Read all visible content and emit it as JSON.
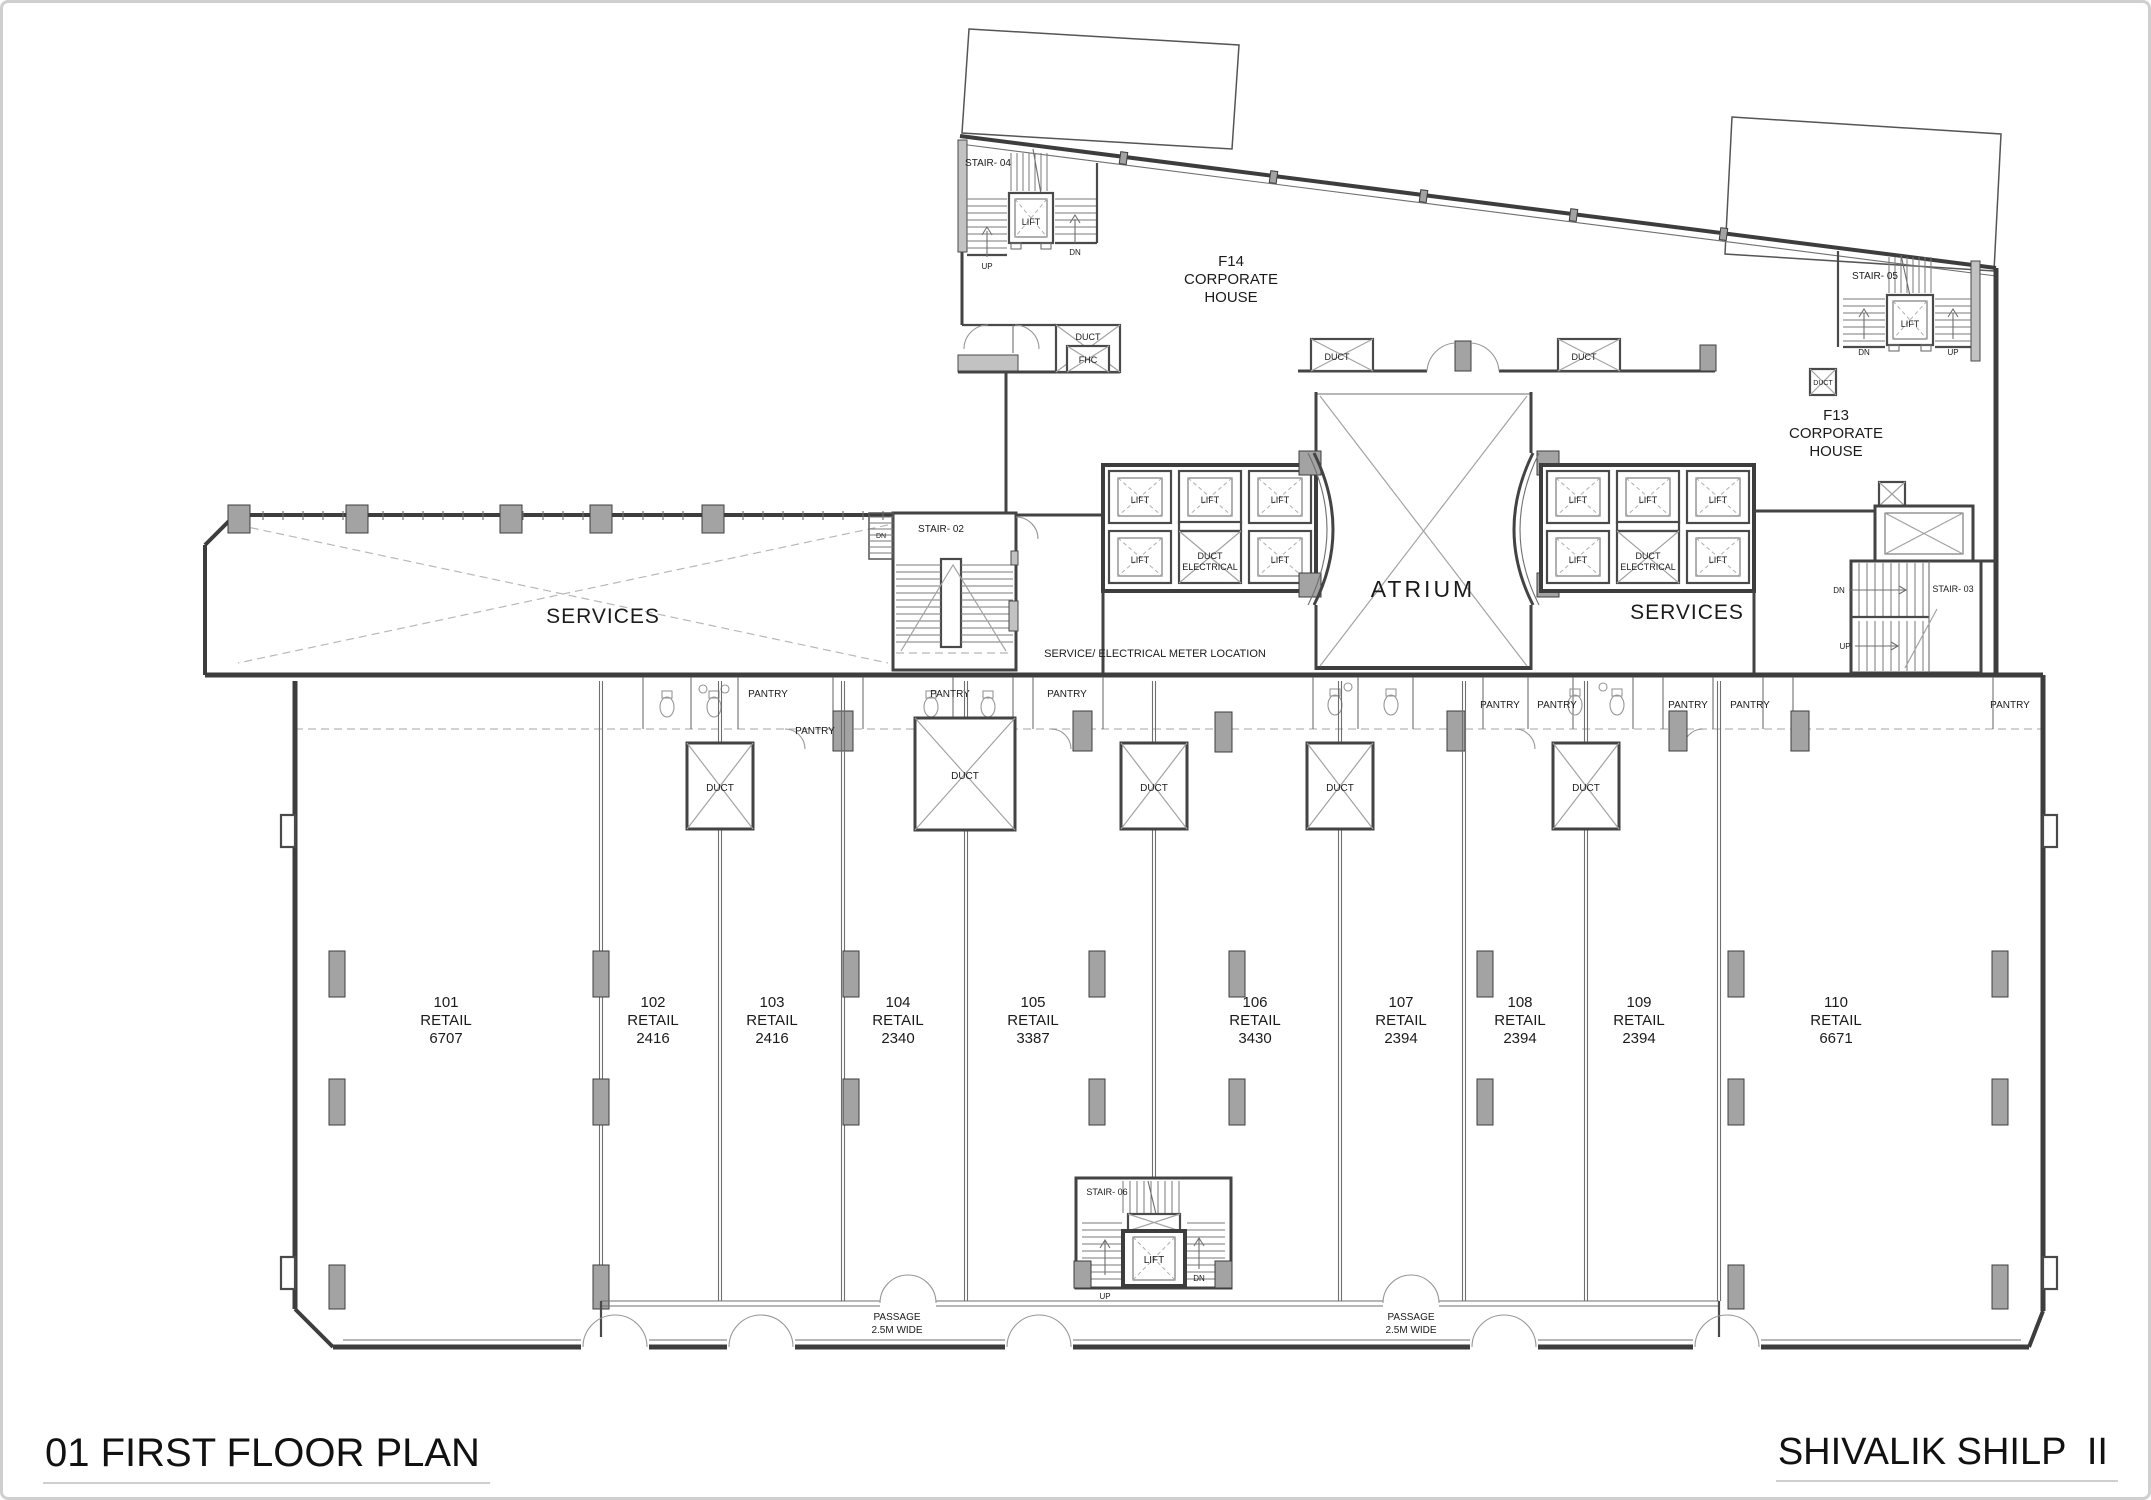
{
  "titles": {
    "plan_title": "01 FIRST FLOOR PLAN",
    "project_title": "SHIVALIK SHILP  II"
  },
  "labels": {
    "lift": "LIFT",
    "duct": "DUCT",
    "fhc": "FHC",
    "pantry": "PANTRY",
    "up": "UP",
    "dn": "DN",
    "atrium": "ATRIUM",
    "services": "SERVICES",
    "duct_electrical": [
      "DUCT",
      "ELECTRICAL"
    ],
    "meter_note": "SERVICE/ ELECTRICAL METER LOCATION",
    "passage": [
      "PASSAGE",
      "2.5M WIDE"
    ]
  },
  "stairs": {
    "s02": "STAIR- 02",
    "s03": "STAIR- 03",
    "s04": "STAIR- 04",
    "s05": "STAIR- 05",
    "s06": "STAIR- 06"
  },
  "corporate_houses": {
    "f14": [
      "F14",
      "CORPORATE",
      "HOUSE"
    ],
    "f13": [
      "F13",
      "CORPORATE",
      "HOUSE"
    ]
  },
  "retail_units": [
    {
      "number": "101",
      "type": "RETAIL",
      "area": "6707"
    },
    {
      "number": "102",
      "type": "RETAIL",
      "area": "2416"
    },
    {
      "number": "103",
      "type": "RETAIL",
      "area": "2416"
    },
    {
      "number": "104",
      "type": "RETAIL",
      "area": "2340"
    },
    {
      "number": "105",
      "type": "RETAIL",
      "area": "3387"
    },
    {
      "number": "106",
      "type": "RETAIL",
      "area": "3430"
    },
    {
      "number": "107",
      "type": "RETAIL",
      "area": "2394"
    },
    {
      "number": "108",
      "type": "RETAIL",
      "area": "2394"
    },
    {
      "number": "109",
      "type": "RETAIL",
      "area": "2394"
    },
    {
      "number": "110",
      "type": "RETAIL",
      "area": "6671"
    }
  ],
  "colors": {
    "wall": "#3d3d3d",
    "thin_line": "#6f6f6f",
    "column_fill": "#a3a3a3",
    "frame": "#cfcfcf",
    "text": "#1b1b1b"
  }
}
